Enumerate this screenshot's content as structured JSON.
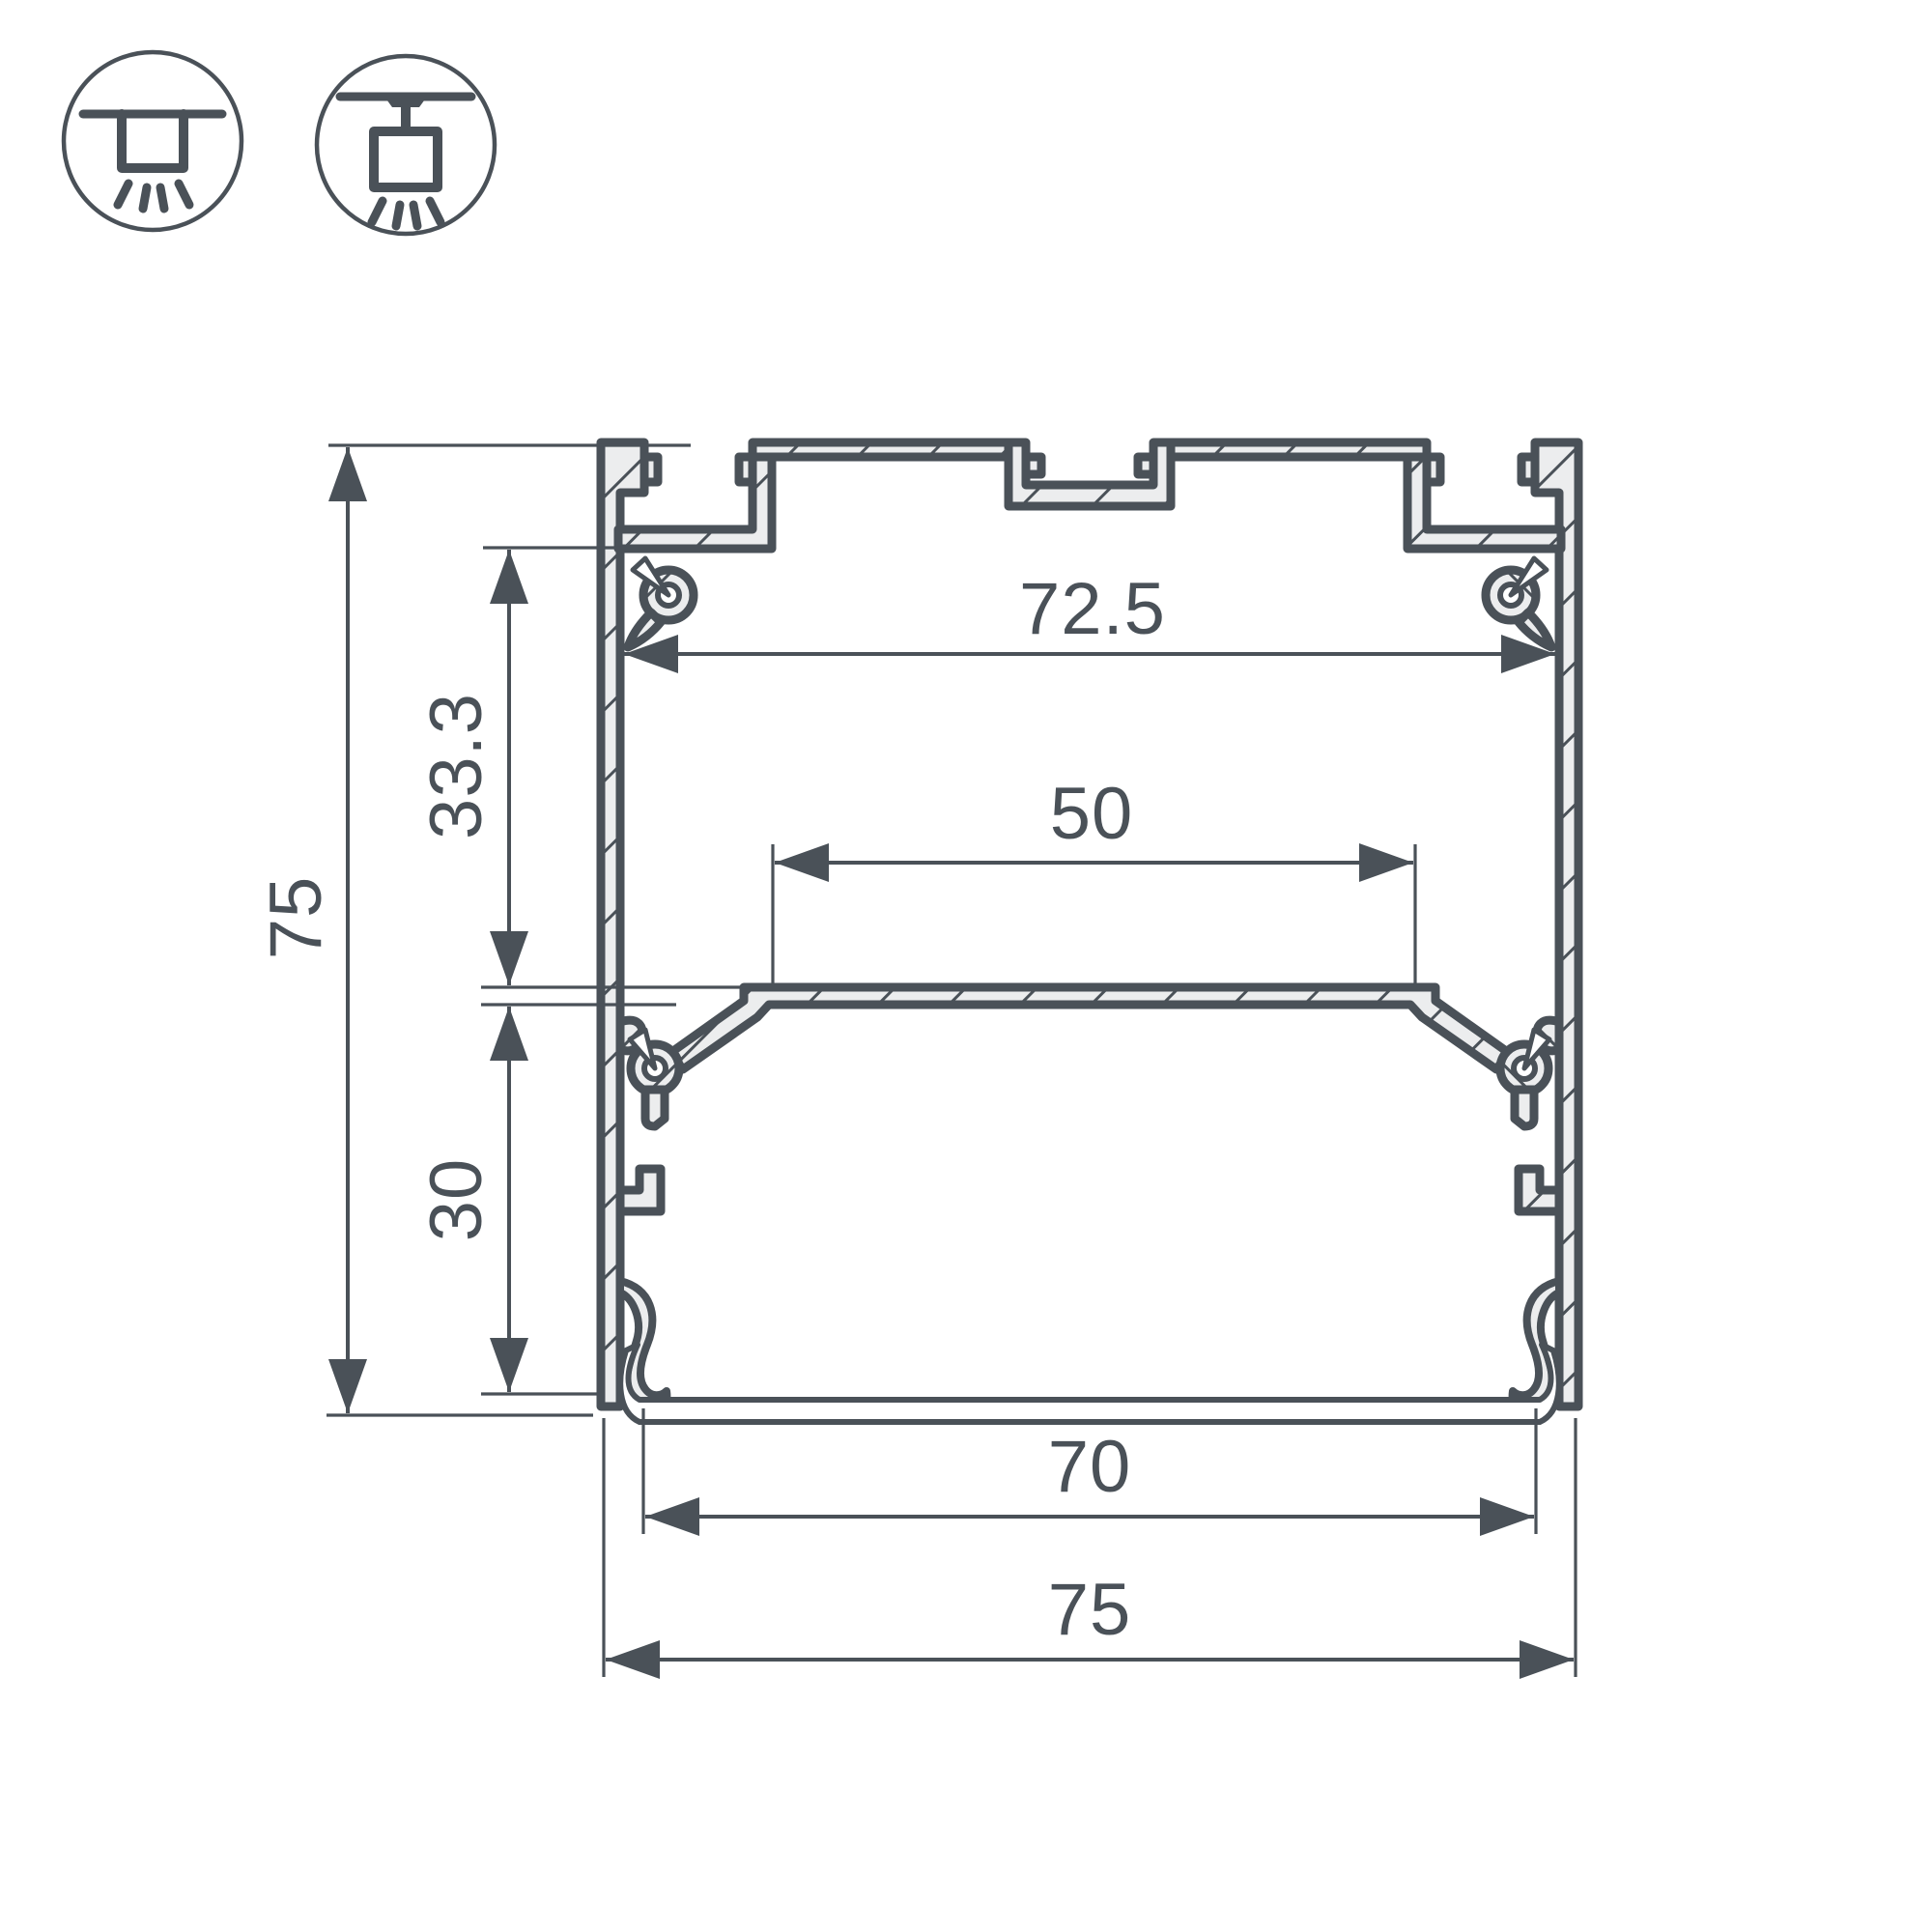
{
  "drawing": {
    "type": "technical-cross-section",
    "subject": "aluminum LED profile cross-section with dimensions",
    "dimensions": {
      "inner_top_width": "72.5",
      "upper_inner_height": "33.3",
      "overall_height": "75",
      "led_area_width": "50",
      "lower_inner_height": "30",
      "inner_bottom_width": "70",
      "overall_width": "75"
    },
    "icons": [
      {
        "name": "recessed-mount-icon"
      },
      {
        "name": "surface-mount-icon"
      }
    ],
    "colors": {
      "line": "#4a5158",
      "metal_fill": "#ecedee",
      "background": "#ffffff"
    }
  }
}
